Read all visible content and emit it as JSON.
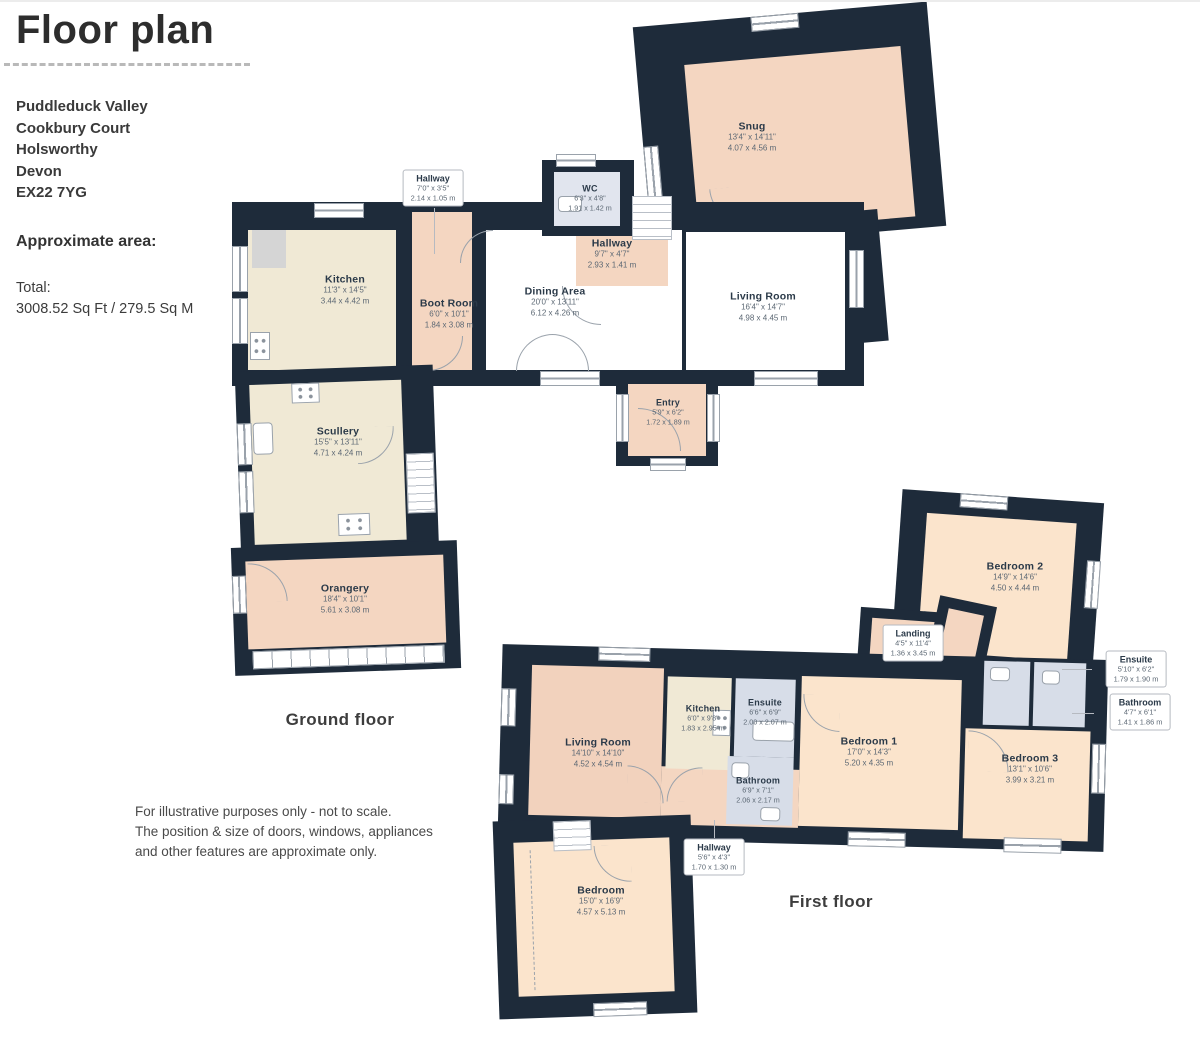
{
  "header": {
    "title": "Floor plan",
    "address_lines": [
      "Puddleduck Valley",
      "Cookbury Court",
      "Holsworthy",
      "Devon",
      "EX22 7YG"
    ],
    "area_heading": "Approximate area:",
    "total_label": "Total:",
    "total_value": "3008.52 Sq Ft / 279.5 Sq M"
  },
  "disclaimer_lines": [
    "For illustrative purposes only - not to scale.",
    "The position & size of doors, windows, appliances",
    "and other features are approximate only."
  ],
  "colors": {
    "wall": "#1e2b3a",
    "room_peach": "#f4d6c1",
    "room_cream": "#f0e9d5",
    "room_bedroom": "#fbe4cc",
    "room_bath": "#d7dde8",
    "room_white": "#ffffff"
  },
  "floors": {
    "ground": {
      "label": "Ground floor",
      "rooms": {
        "kitchen": {
          "name": "Kitchen",
          "imperial": "11'3\" x 14'5\"",
          "metric": "3.44 x 4.42 m"
        },
        "boot_room": {
          "name": "Boot Room",
          "imperial": "6'0\" x 10'1\"",
          "metric": "1.84 x 3.08 m"
        },
        "hallway_small": {
          "name": "Hallway",
          "imperial": "7'0\" x 3'5\"",
          "metric": "2.14 x 1.05 m"
        },
        "wc": {
          "name": "WC",
          "imperial": "6'3\" x 4'8\"",
          "metric": "1.91 x 1.42 m"
        },
        "hallway": {
          "name": "Hallway",
          "imperial": "9'7\" x 4'7\"",
          "metric": "2.93 x 1.41 m"
        },
        "dining_area": {
          "name": "Dining Area",
          "imperial": "20'0\" x 13'11\"",
          "metric": "6.12 x 4.26 m"
        },
        "living_room": {
          "name": "Living Room",
          "imperial": "16'4\" x 14'7\"",
          "metric": "4.98 x 4.45 m"
        },
        "snug": {
          "name": "Snug",
          "imperial": "13'4\" x 14'11\"",
          "metric": "4.07 x 4.56 m"
        },
        "entry": {
          "name": "Entry",
          "imperial": "5'9\" x 6'2\"",
          "metric": "1.72 x 1.89 m"
        },
        "scullery": {
          "name": "Scullery",
          "imperial": "15'5\" x 13'11\"",
          "metric": "4.71 x 4.24 m"
        },
        "orangery": {
          "name": "Orangery",
          "imperial": "18'4\" x 10'1\"",
          "metric": "5.61 x 3.08 m"
        }
      }
    },
    "first": {
      "label": "First floor",
      "rooms": {
        "bedroom2": {
          "name": "Bedroom 2",
          "imperial": "14'9\" x 14'6\"",
          "metric": "4.50 x 4.44 m"
        },
        "landing": {
          "name": "Landing",
          "imperial": "4'5\" x 11'4\"",
          "metric": "1.36 x 3.45 m"
        },
        "living_room": {
          "name": "Living Room",
          "imperial": "14'10\" x 14'10\"",
          "metric": "4.52 x 4.54 m"
        },
        "kitchen": {
          "name": "Kitchen",
          "imperial": "6'0\" x 9'8\"",
          "metric": "1.83 x 2.95 m"
        },
        "ensuite1": {
          "name": "Ensuite",
          "imperial": "6'6\" x 6'9\"",
          "metric": "2.00 x 2.07 m"
        },
        "bathroom1": {
          "name": "Bathroom",
          "imperial": "6'9\" x 7'1\"",
          "metric": "2.06 x 2.17 m"
        },
        "bedroom1": {
          "name": "Bedroom 1",
          "imperial": "17'0\" x 14'3\"",
          "metric": "5.20 x 4.35 m"
        },
        "bedroom3": {
          "name": "Bedroom 3",
          "imperial": "13'1\" x 10'6\"",
          "metric": "3.99 x 3.21 m"
        },
        "ensuite2": {
          "name": "Ensuite",
          "imperial": "5'10\" x 6'2\"",
          "metric": "1.79 x 1.90 m"
        },
        "bathroom2": {
          "name": "Bathroom",
          "imperial": "4'7\" x 6'1\"",
          "metric": "1.41 x 1.86 m"
        },
        "hallway": {
          "name": "Hallway",
          "imperial": "5'6\" x 4'3\"",
          "metric": "1.70 x 1.30 m"
        },
        "bedroom": {
          "name": "Bedroom",
          "imperial": "15'0\" x 16'9\"",
          "metric": "4.57 x 5.13 m"
        }
      }
    }
  }
}
